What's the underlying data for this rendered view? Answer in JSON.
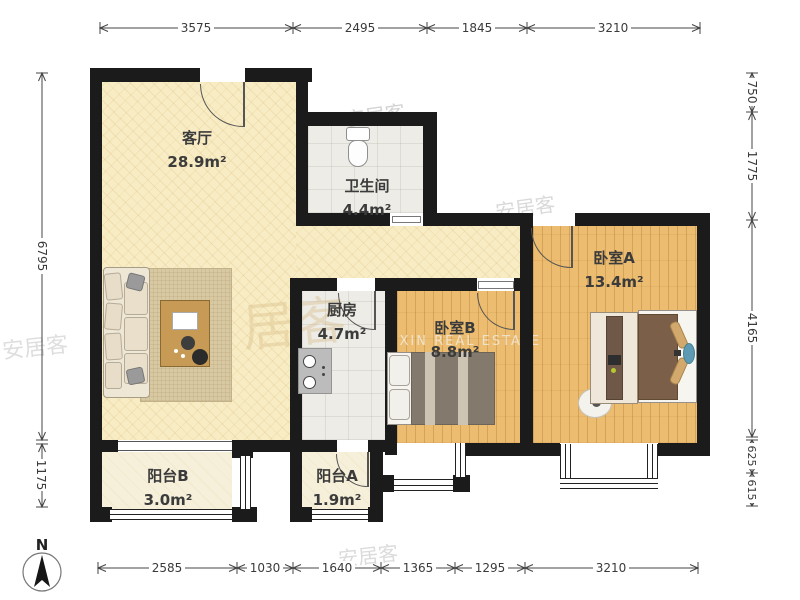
{
  "rooms": [
    {
      "id": "living",
      "name": "客厅",
      "area": "28.9m²"
    },
    {
      "id": "bathroom",
      "name": "卫生间",
      "area": "4.4m²"
    },
    {
      "id": "kitchen",
      "name": "厨房",
      "area": "4.7m²"
    },
    {
      "id": "bedroomA",
      "name": "卧室A",
      "area": "13.4m²"
    },
    {
      "id": "bedroomB",
      "name": "卧室B",
      "area": "8.8m²"
    },
    {
      "id": "balconyB",
      "name": "阳台B",
      "area": "3.0m²"
    },
    {
      "id": "balconyA",
      "name": "阳台A",
      "area": "1.9m²"
    }
  ],
  "dimensions": {
    "top": [
      "3575",
      "2495",
      "1845",
      "3210"
    ],
    "bottom": [
      "2585",
      "1030",
      "1640",
      "1365",
      "1295",
      "3210"
    ],
    "left": [
      "6795",
      "1175"
    ],
    "right": [
      "750",
      "1775",
      "4165",
      "625",
      "615"
    ]
  },
  "compass": {
    "north_label": "N"
  },
  "watermarks": {
    "brand": "安居客",
    "agency": "UXIN REAL ESTATE",
    "partial": "居客"
  },
  "colors": {
    "wall": "#1b1b1b",
    "floor_cream": "#f8ecc4",
    "floor_wood": "#ecbd70",
    "floor_tile": "#edece6",
    "floor_balcony": "#f6f0da",
    "dimension_line": "#444",
    "label_text": "#3b3b3b"
  }
}
